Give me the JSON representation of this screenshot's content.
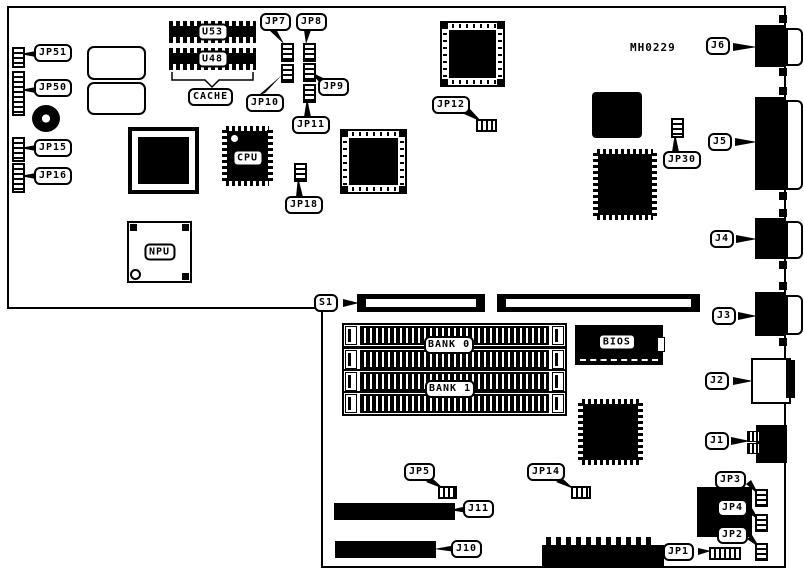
{
  "board": {
    "part_number": "MH0229"
  },
  "labels": {
    "jp51": "JP51",
    "jp50": "JP50",
    "jp15": "JP15",
    "jp16": "JP16",
    "u53": "U53",
    "u48": "U48",
    "cache": "CACHE",
    "cpu": "CPU",
    "npu": "NPU",
    "jp7": "JP7",
    "jp8": "JP8",
    "jp9": "JP9",
    "jp10": "JP10",
    "jp11": "JP11",
    "jp18": "JP18",
    "jp12": "JP12",
    "jp30": "JP30",
    "j6": "J6",
    "j5": "J5",
    "j4": "J4",
    "j3": "J3",
    "j2": "J2",
    "j1": "J1",
    "s1": "S1",
    "bank0": "BANK 0",
    "bank1": "BANK 1",
    "bios": "BIOS",
    "jp5": "JP5",
    "jp14": "JP14",
    "j11": "J11",
    "j10": "J10",
    "jp3": "JP3",
    "jp4": "JP4",
    "jp2": "JP2",
    "jp1": "JP1"
  },
  "colors": {
    "line": "#000000",
    "background": "#ffffff"
  }
}
